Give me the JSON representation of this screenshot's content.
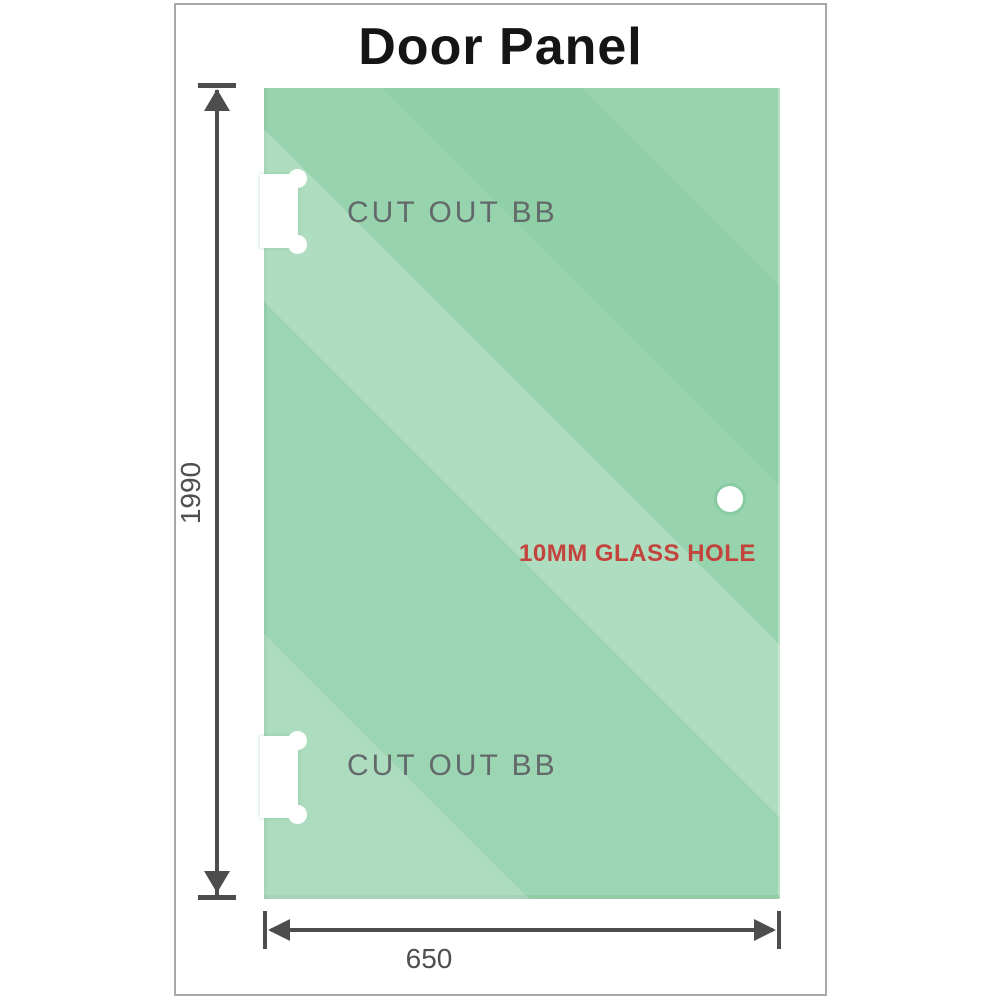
{
  "title": "Door Panel",
  "labels": {
    "cut_out_top": "CUT OUT BB",
    "cut_out_bottom": "CUT OUT BB",
    "glass_hole": "10MM GLASS HOLE"
  },
  "dimensions": {
    "height": "1990",
    "width": "650"
  },
  "colors": {
    "glass_green": "#89CDA2",
    "glass_edge_green": "#6FBE91",
    "dimension_gray": "#4D4D4D",
    "cutout_label_gray": "#63696A",
    "hole_label_red": "#C2443C",
    "frame_border_gray": "#A9A9A9",
    "title_black": "#151515"
  }
}
